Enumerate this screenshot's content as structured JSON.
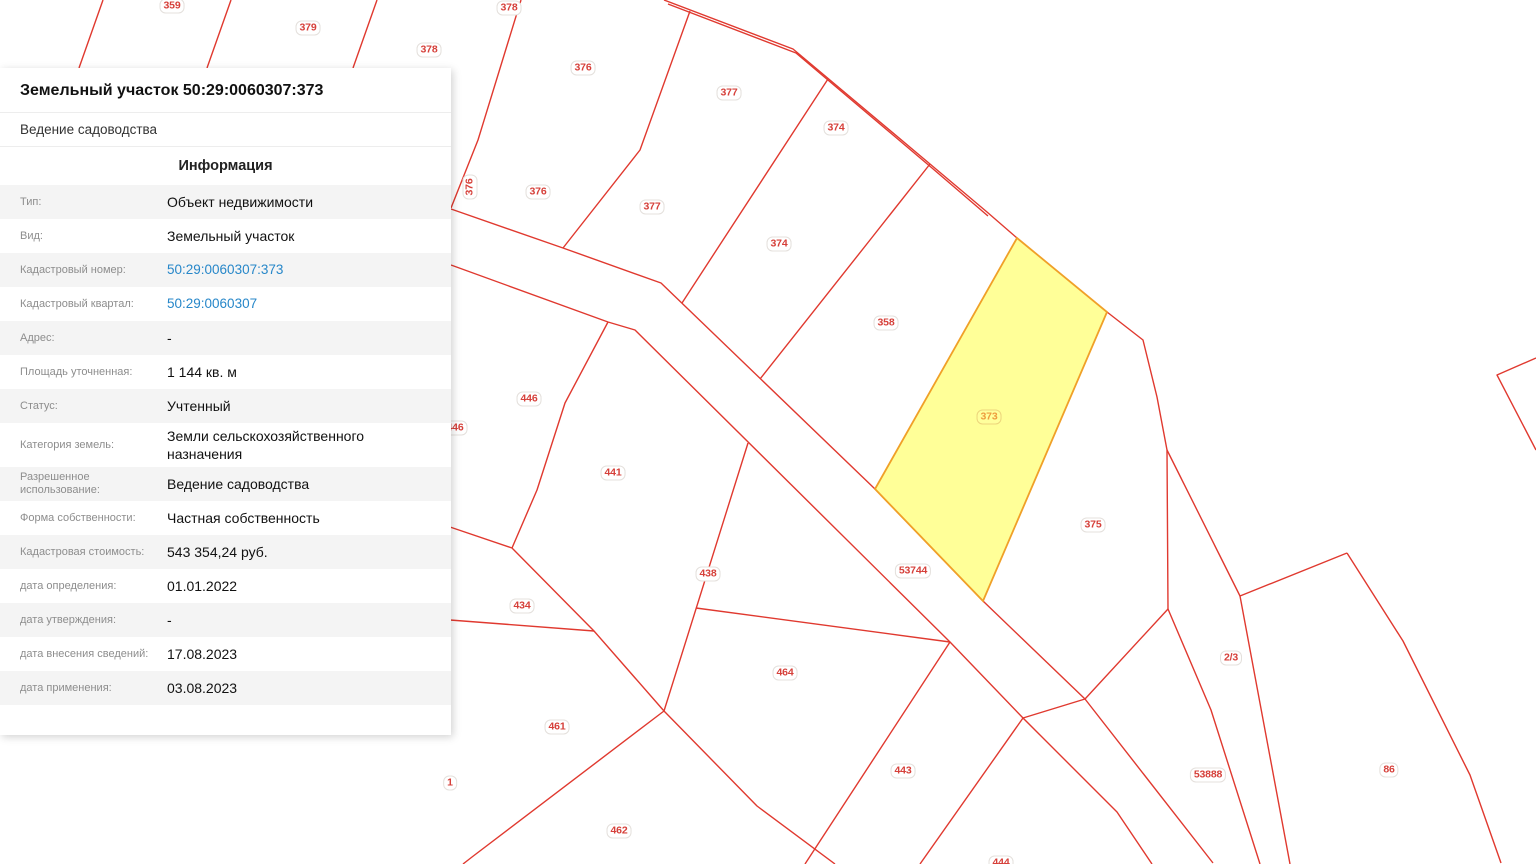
{
  "colors": {
    "boundary_red": "#e0392f",
    "label_red": "#d6403a",
    "highlight_fill": "#ffff8f",
    "highlight_stroke": "#f0a028",
    "highlight_label": "#ee9c3e",
    "link_blue": "#2787c9",
    "row_zebra": "#f4f4f4"
  },
  "panel": {
    "title": "Земельный участок 50:29:0060307:373",
    "subtitle": "Ведение садоводства",
    "section_title": "Информация",
    "rows": [
      {
        "label": "Тип:",
        "value": "Объект недвижимости",
        "link": false
      },
      {
        "label": "Вид:",
        "value": "Земельный участок",
        "link": false
      },
      {
        "label": "Кадастровый номер:",
        "value": "50:29:0060307:373",
        "link": true
      },
      {
        "label": "Кадастровый квартал:",
        "value": "50:29:0060307",
        "link": true
      },
      {
        "label": "Адрес:",
        "value": "-",
        "link": false
      },
      {
        "label": "Площадь уточненная:",
        "value": "1 144 кв. м",
        "link": false
      },
      {
        "label": "Статус:",
        "value": "Учтенный",
        "link": false
      },
      {
        "label": "Категория земель:",
        "value": "Земли сельскохозяйственного назначения",
        "link": false
      },
      {
        "label": "Разрешенное использование:",
        "value": "Ведение садоводства",
        "link": false
      },
      {
        "label": "Форма собственности:",
        "value": "Частная собственность",
        "link": false
      },
      {
        "label": "Кадастровая стоимость:",
        "value": "543 354,24 руб.",
        "link": false
      },
      {
        "label": "дата определения:",
        "value": "01.01.2022",
        "link": false
      },
      {
        "label": "дата утверждения:",
        "value": "-",
        "link": false
      },
      {
        "label": "дата внесения сведений:",
        "value": "17.08.2023",
        "link": false
      },
      {
        "label": "дата применения:",
        "value": "03.08.2023",
        "link": false
      }
    ]
  },
  "map": {
    "highlighted_parcel": "373",
    "labels": [
      {
        "t": "359",
        "x": 172,
        "y": 6
      },
      {
        "t": "379",
        "x": 308,
        "y": 28
      },
      {
        "t": "378",
        "x": 429,
        "y": 50
      },
      {
        "t": "378",
        "x": 509,
        "y": 8
      },
      {
        "t": "376",
        "x": 583,
        "y": 68
      },
      {
        "t": "377",
        "x": 729,
        "y": 93
      },
      {
        "t": "374",
        "x": 836,
        "y": 128
      },
      {
        "t": "376",
        "x": 470,
        "y": 187,
        "rot": true
      },
      {
        "t": "376",
        "x": 538,
        "y": 192
      },
      {
        "t": "377",
        "x": 652,
        "y": 207
      },
      {
        "t": "374",
        "x": 779,
        "y": 244
      },
      {
        "t": "358",
        "x": 886,
        "y": 323
      },
      {
        "t": "446",
        "x": 529,
        "y": 399
      },
      {
        "t": "446",
        "x": 455,
        "y": 428
      },
      {
        "t": "441",
        "x": 613,
        "y": 473
      },
      {
        "t": "373",
        "x": 989,
        "y": 417,
        "hl": true
      },
      {
        "t": "375",
        "x": 1093,
        "y": 525
      },
      {
        "t": "53744",
        "x": 913,
        "y": 571
      },
      {
        "t": "438",
        "x": 708,
        "y": 574
      },
      {
        "t": "434",
        "x": 522,
        "y": 606
      },
      {
        "t": "2/3",
        "x": 1231,
        "y": 658
      },
      {
        "t": "464",
        "x": 785,
        "y": 673
      },
      {
        "t": "461",
        "x": 557,
        "y": 727
      },
      {
        "t": "1",
        "x": 450,
        "y": 783
      },
      {
        "t": "443",
        "x": 903,
        "y": 771
      },
      {
        "t": "53888",
        "x": 1208,
        "y": 775
      },
      {
        "t": "86",
        "x": 1389,
        "y": 770
      },
      {
        "t": "462",
        "x": 619,
        "y": 831
      },
      {
        "t": "444",
        "x": 1001,
        "y": 863
      }
    ]
  }
}
